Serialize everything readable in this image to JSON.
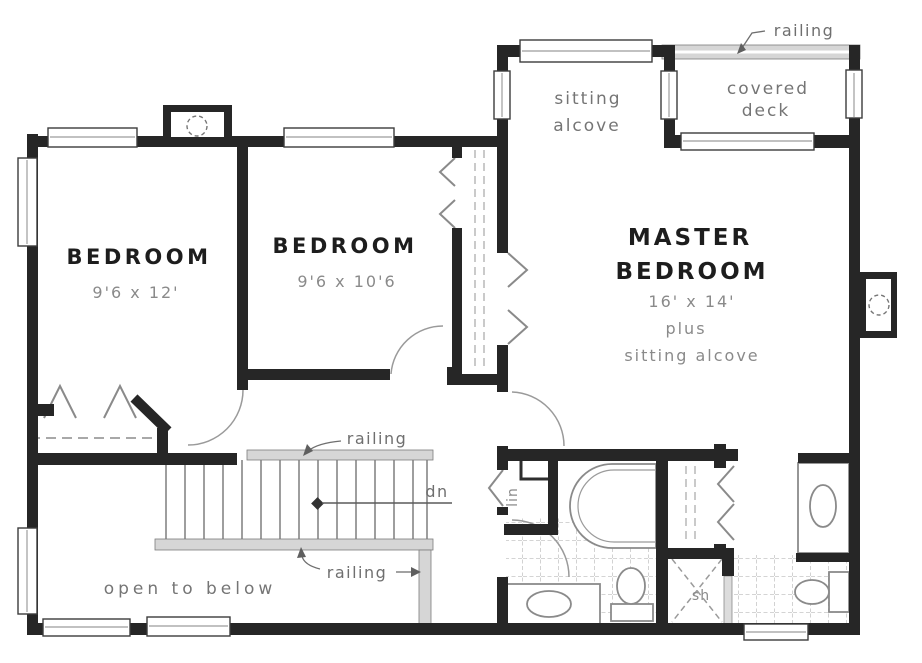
{
  "plan": {
    "rooms": {
      "bedroom1": {
        "name": "BEDROOM",
        "dims": "9'6 x 12'"
      },
      "bedroom2": {
        "name": "BEDROOM",
        "dims": "9'6 x 10'6"
      },
      "master": {
        "name1": "MASTER",
        "name2": "BEDROOM",
        "dims": "16' x 14'",
        "plus": "plus",
        "extra": "sitting alcove"
      },
      "alcove": {
        "l1": "sitting",
        "l2": "alcove"
      },
      "deck": {
        "l1": "covered",
        "l2": "deck"
      }
    },
    "labels": {
      "railing_deck": "railing",
      "railing_stairs_top": "railing",
      "railing_stairs_bottom": "railing",
      "down": "dn",
      "open_below": "open to below",
      "shower": "sh",
      "linen": "lin"
    },
    "colors": {
      "wall": "#262626",
      "ink": "#1d1d1d",
      "annotation_gray": "#6f6f6f",
      "dimension_gray": "#8a8a8a",
      "railing_fill": "#d6d6d6",
      "tile_line": "#b9b9b9",
      "door_arc": "#9a9a9a",
      "background": "#ffffff"
    }
  }
}
